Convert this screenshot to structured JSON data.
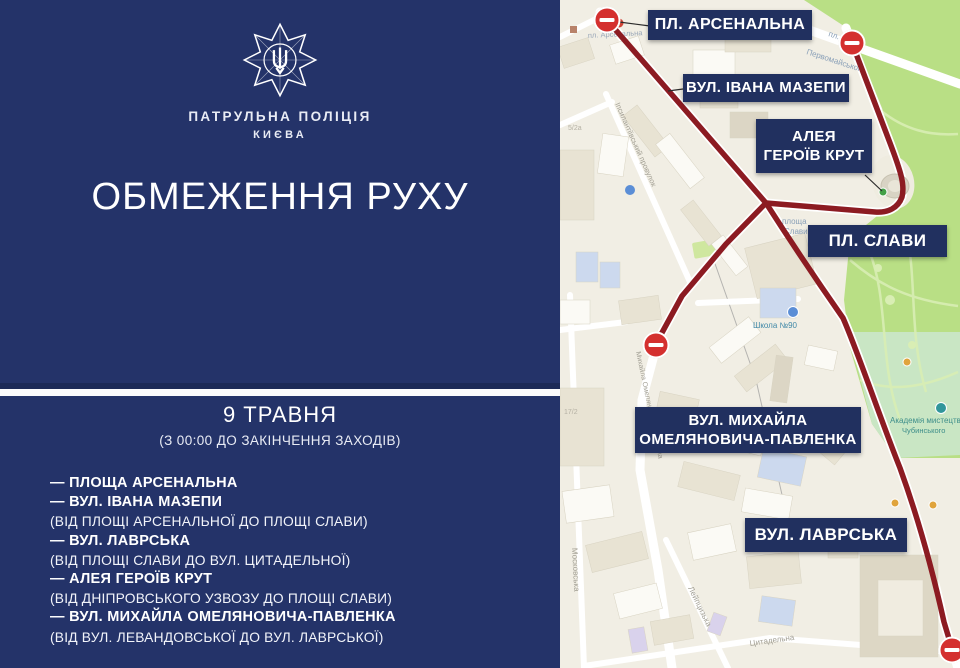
{
  "brand": {
    "org": "ПАТРУЛЬНА ПОЛІЦІЯ",
    "city": "КИЄВА"
  },
  "headline": "ОБМЕЖЕННЯ РУХУ",
  "schedule": {
    "date": "9 ТРАВНЯ",
    "note": "(З 00:00 ДО ЗАКІНЧЕННЯ ЗАХОДІВ)"
  },
  "restrictions": [
    {
      "street": "— ПЛОЩА АРСЕНАЛЬНА",
      "detail": ""
    },
    {
      "street": "— ВУЛ. ІВАНА МАЗЕПИ",
      "detail": "(ВІД ПЛОЩІ АРСЕНАЛЬНОЇ ДО ПЛОЩІ СЛАВИ)"
    },
    {
      "street": "— ВУЛ. ЛАВРСЬКА",
      "detail": "(ВІД ПЛОЩІ СЛАВИ ДО ВУЛ. ЦИТАДЕЛЬНОЇ)"
    },
    {
      "street": "— АЛЕЯ ГЕРОЇВ КРУТ",
      "detail": "(ВІД ДНІПРОВСЬКОГО УЗВОЗУ ДО ПЛОЩІ СЛАВИ)"
    },
    {
      "street": "— ВУЛ. МИХАЙЛА ОМЕЛЯНОВИЧА-ПАВЛЕНКА",
      "detail": "(ВІД ВУЛ. ЛЕВАНДОВСЬКОЇ ДО ВУЛ. ЛАВРСЬКОЇ)"
    }
  ],
  "map": {
    "callouts": [
      {
        "line1": "ПЛ. АРСЕНАЛЬНА"
      },
      {
        "line1": "ВУЛ. ІВАНА МАЗЕПИ"
      },
      {
        "line1": "АЛЕЯ",
        "line2": "ГЕРОЇВ КРУТ"
      },
      {
        "line1": "ПЛ. СЛАВИ"
      },
      {
        "line1": "ВУЛ. МИХАЙЛА",
        "line2": "ОМЕЛЯНОВИЧА-ПАВЛЕНКА"
      },
      {
        "line1": "ВУЛ. ЛАВРСЬКА"
      }
    ],
    "street_labels": [
      "пл. Арсенальна",
      "пл.",
      "Первомайського",
      "Іпсилантіївський провулок",
      "площа",
      "Слави",
      "Школа №90",
      "Михайла Омеляновича-Павленка",
      "Академія мистецтв",
      "Чубинського",
      "Московська",
      "Лейпцизька",
      "Цитадельна",
      "5/2а",
      "17/2"
    ]
  },
  "colors": {
    "panel_navy": "#243369",
    "callout_navy": "#21305f",
    "route_red": "#8c1b22",
    "sign_red": "#d4302f",
    "park_green": "#b9df85",
    "academy_green": "#c9e6c4",
    "map_bg": "#f1eee4"
  }
}
